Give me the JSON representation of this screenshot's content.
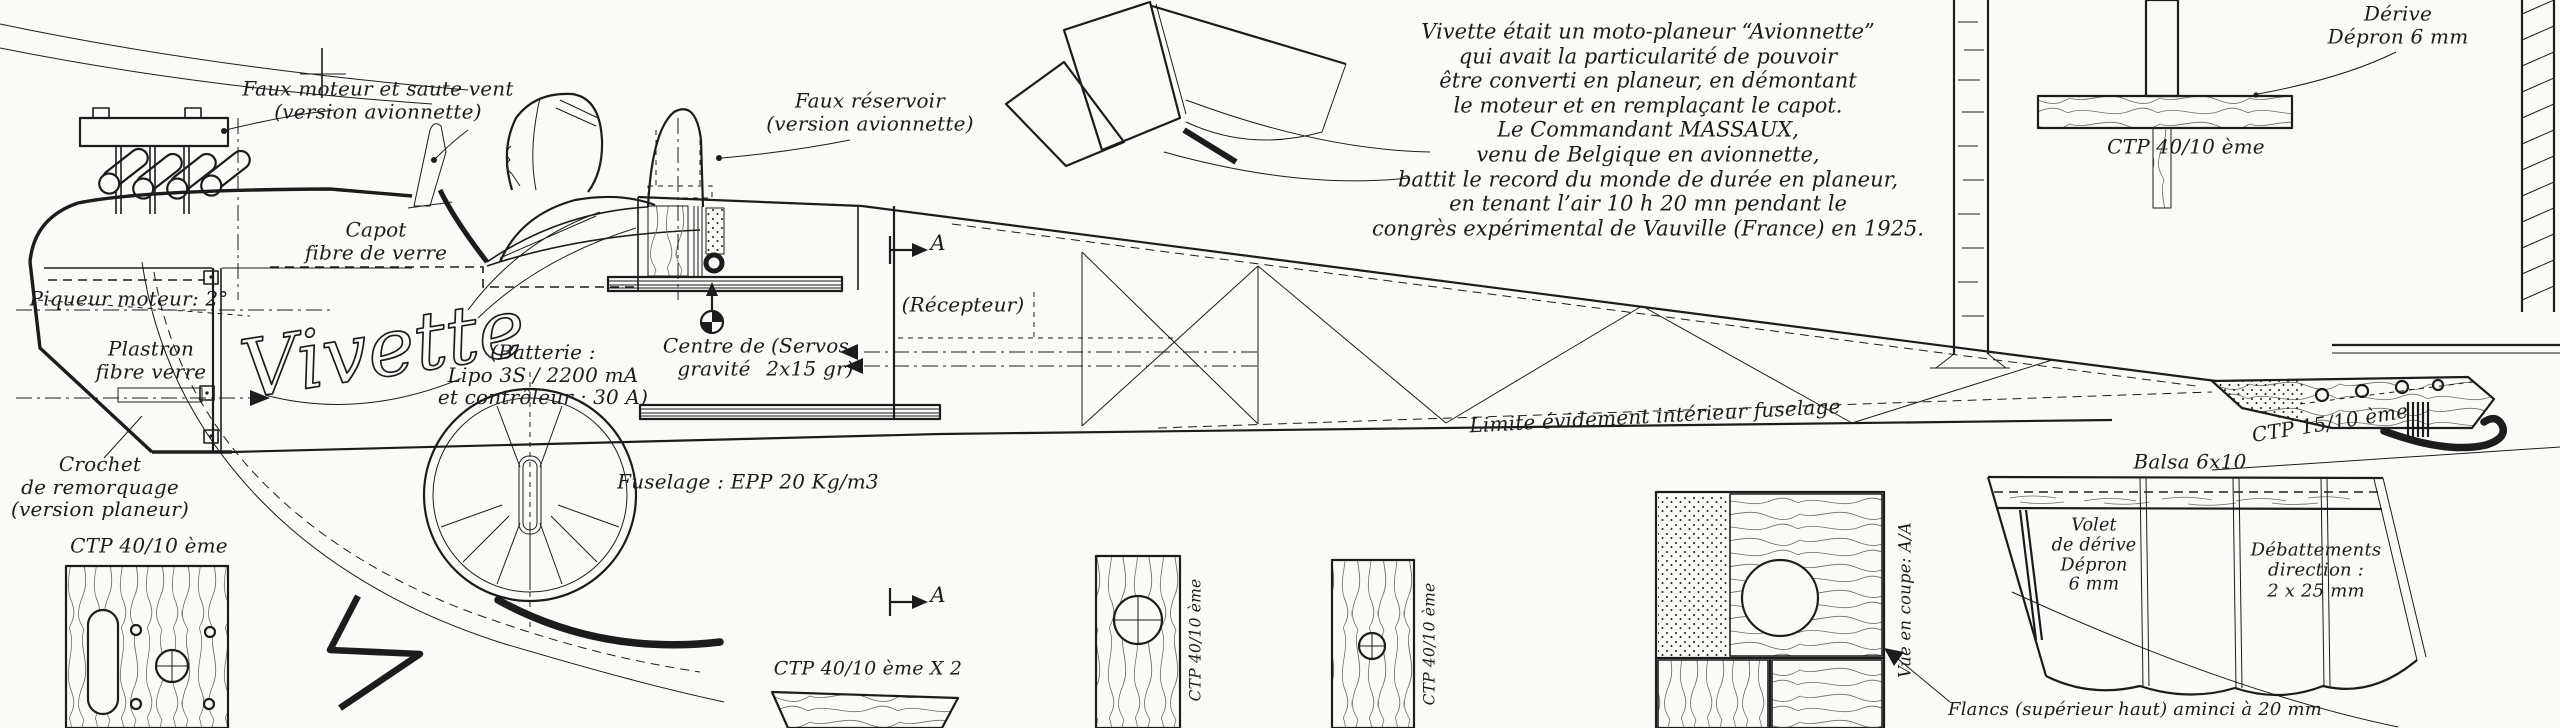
{
  "colors": {
    "ink": "#1c1c1c",
    "paper": "#fbfaf7"
  },
  "labels": {
    "logo": "Vivette",
    "faux_moteur": "Faux moteur et saute vent\n(version avionnette)",
    "faux_reservoir": "Faux réservoir\n(version avionnette)",
    "capot": "Capot\nfibre de verre",
    "piqueur_moteur": "Piqueur moteur: 2°",
    "plastron": "Plastron\nfibre verre",
    "crochet": "Crochet\nde remorquage\n(version planeur)",
    "ctp_4010_nose": "CTP 40/10 ème",
    "batterie": "(Batterie :\nLipo 3S / 2200 mA\net contrôleur : 30 A)",
    "centre_gravite": "Centre de\ngravité",
    "servos": "(Servos\n2x15 gr)",
    "recepteur": "(Récepteur)",
    "fuselage_epp": "Fuselage : EPP 20 Kg/m3",
    "limite_evidement": "Limite évidement intérieur fuselage",
    "section_a_top": "A",
    "section_a_bottom": "A",
    "ctp_4010_x2": "CTP 40/10 ème X 2",
    "ctp_4010_plank1": "CTP 40/10 ème",
    "ctp_4010_plank2": "CTP 40/10 ème",
    "vue_en_coupe": "Vue en coupe: A/A",
    "derive": "Dérive\nDépron 6 mm",
    "ctp_4010_derive": "CTP 40/10 ème",
    "ctp_1510": "CTP 15/10 ème",
    "balsa_6x10": "Balsa 6x10",
    "volet_derive": "Volet\nde dérive\nDépron\n6 mm",
    "debattements": "Débattements\ndirection :\n2 x 25 mm",
    "flancs": "Flancs (supérieur haut) aminci à 20 mm"
  },
  "history": {
    "lines": [
      "Vivette était un moto-planeur “Avionnette”",
      "qui avait la particularité de pouvoir",
      "être converti en planeur, en démontant",
      "le moteur et en remplaçant le capot.",
      "Le Commandant MASSAUX,",
      "venu de Belgique en avionnette,",
      "battit le record du monde de durée en planeur,",
      "en tenant l’air 10 h 20 mn pendant le",
      "congrès expérimental de Vauville (France) en 1925."
    ]
  }
}
